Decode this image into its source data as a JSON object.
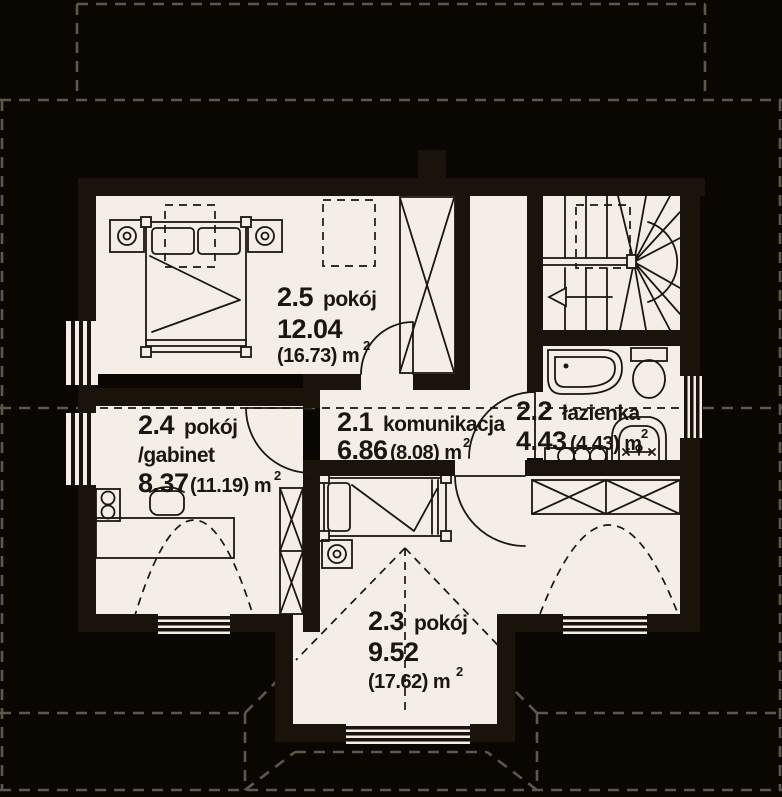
{
  "plan": {
    "type": "architectural-floor-plan",
    "rooms": [
      {
        "id": "2.5",
        "name": "pokój",
        "name2": "",
        "area": "12.04",
        "gross": "(16.73) m",
        "sup": "2"
      },
      {
        "id": "2.4",
        "name": "pokój",
        "name2": "/gabinet",
        "area": "8.37",
        "gross": "(11.19) m",
        "sup": "2"
      },
      {
        "id": "2.1",
        "name": "komunikacja",
        "name2": "",
        "area": "6.86",
        "gross": "(8.08) m",
        "sup": "2"
      },
      {
        "id": "2.2",
        "name": "łazienka",
        "name2": "",
        "area": "4.43",
        "gross": "(4.43) m",
        "sup": "2"
      },
      {
        "id": "2.3",
        "name": "pokój",
        "name2": "",
        "area": "9.52",
        "gross": "(17.62) m",
        "sup": "2"
      }
    ]
  },
  "colors": {
    "bg": "#0a0703",
    "floor": "#f4eee7",
    "wall": "#1a130a",
    "dash": "#60564a",
    "ink": "#1d160e"
  }
}
